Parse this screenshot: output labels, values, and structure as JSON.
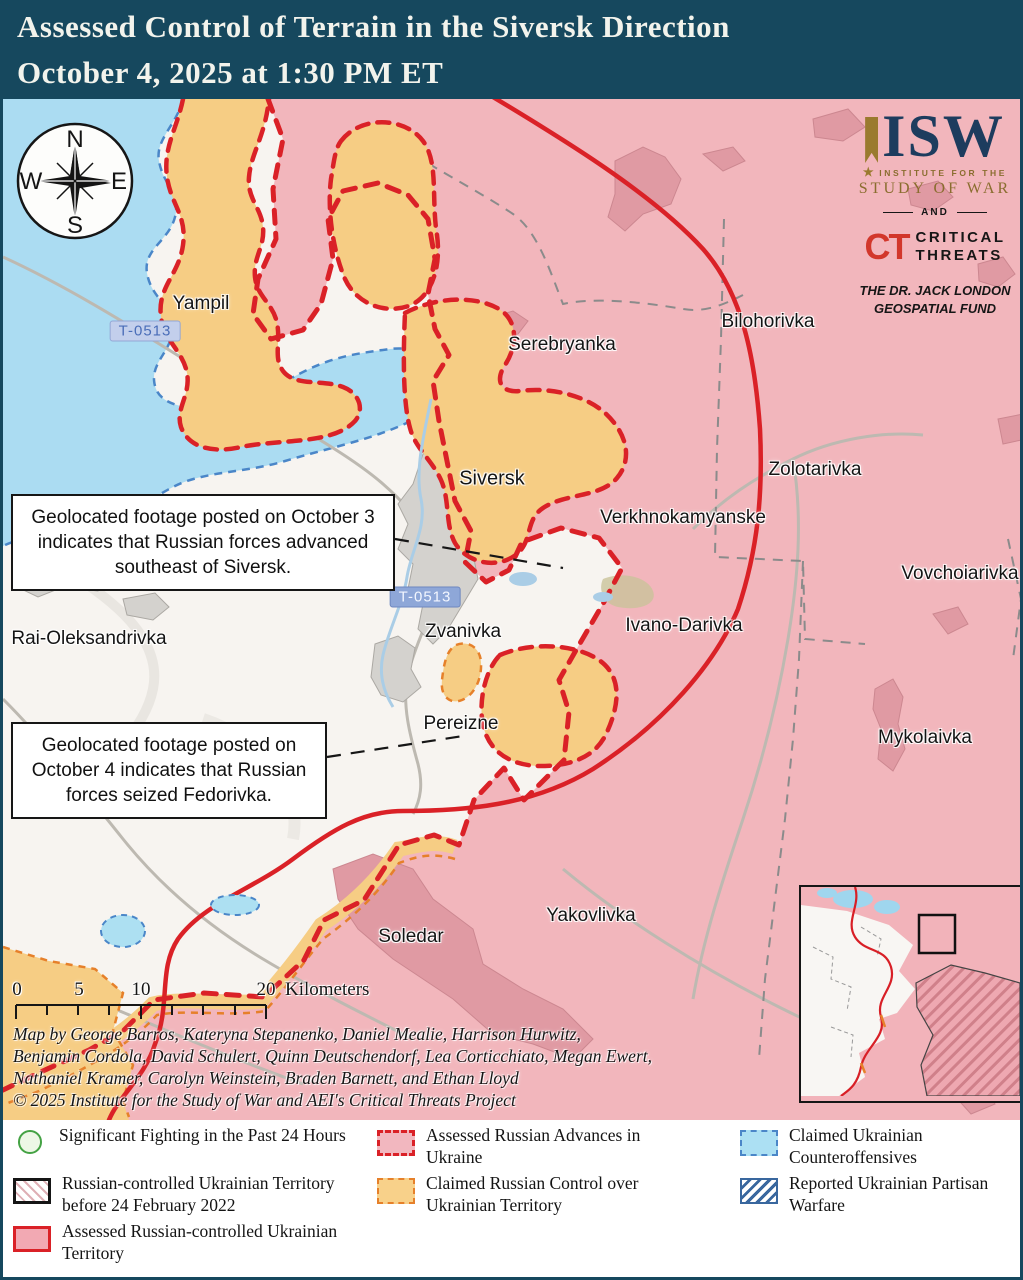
{
  "title": {
    "line1": "Assessed Control of Terrain in the Siversk Direction",
    "line2": "October 4, 2025 at 1:30 PM ET"
  },
  "branding": {
    "isw": "ISW",
    "institute_small": "INSTITUTE FOR THE",
    "study_of_war": "STUDY OF WAR",
    "and": "AND",
    "ct": "CT",
    "critical": "CRITICAL",
    "threats": "THREATS",
    "fund_line1": "THE DR. JACK LONDON",
    "fund_line2": "GEOSPATIAL FUND"
  },
  "compass": {
    "north": "N",
    "east": "E",
    "south": "S",
    "west": "W"
  },
  "map": {
    "labels": [
      {
        "text": "Yampil",
        "x": 198,
        "y": 205
      },
      {
        "text": "Serebryanka",
        "x": 559,
        "y": 246
      },
      {
        "text": "Bilohorivka",
        "x": 765,
        "y": 223
      },
      {
        "text": "Zolotarivka",
        "x": 812,
        "y": 371
      },
      {
        "text": "Verkhnokamyanske",
        "x": 680,
        "y": 419
      },
      {
        "text": "Vovchoiarivka",
        "x": 957,
        "y": 475
      },
      {
        "text": "Siversk",
        "x": 489,
        "y": 380
      },
      {
        "text": "Ivano-Darivka",
        "x": 681,
        "y": 527
      },
      {
        "text": "Rai-Oleksandrivka",
        "x": 86,
        "y": 540
      },
      {
        "text": "Zvanivka",
        "x": 460,
        "y": 533
      },
      {
        "text": "Pereizne",
        "x": 458,
        "y": 625
      },
      {
        "text": "Mykolaivka",
        "x": 922,
        "y": 639
      },
      {
        "text": "Yakovlivka",
        "x": 588,
        "y": 817
      },
      {
        "text": "Soledar",
        "x": 408,
        "y": 838
      }
    ],
    "road_badges": [
      {
        "text": "T-0513",
        "x": 142,
        "y": 232
      },
      {
        "text": "T-0513",
        "x": 422,
        "y": 498
      }
    ],
    "annotations": [
      {
        "text": "Geolocated footage posted on October 3 indicates that Russian forces advanced southeast of Siversk."
      },
      {
        "text": "Geolocated footage posted on October 4 indicates that Russian forces seized Fedorivka."
      }
    ],
    "colors": {
      "title_bar": "#16485e",
      "russian_control_fill": "#f2b6bc",
      "claimed_russian_fill": "#f6cd84",
      "counteroffensive_fill": "#abdcf2",
      "front_line_red": "#da2127",
      "claimed_orange_dash": "#e6802a",
      "ukrainian_blue_dash": "#4a86c8"
    }
  },
  "scale_bar": {
    "tick_labels": [
      "0",
      "5",
      "10",
      "20"
    ],
    "unit": "Kilometers"
  },
  "credits": {
    "line1": "Map by George Barros, Kateryna Stepanenko, Daniel Mealie, Harrison Hurwitz,",
    "line2": "Benjamin Cordola, David Schulert, Quinn Deutschendorf, Lea Corticchiato, Megan Ewert,",
    "line3": "Nathaniel Kramer, Carolyn Weinstein, Braden Barnett, and Ethan Lloyd",
    "line4": "© 2025 Institute for the Study of War and AEI's Critical Threats Project"
  },
  "legend": {
    "items": [
      {
        "label": "Significant Fighting in the Past 24 Hours"
      },
      {
        "label": "Russian-controlled Ukrainian Territory before 24 February 2022"
      },
      {
        "label": "Assessed Russian-controlled Ukrainian Territory"
      },
      {
        "label": "Assessed Russian Advances in Ukraine"
      },
      {
        "label": "Claimed Russian Control over Ukrainian Territory"
      },
      {
        "label": "Claimed Ukrainian Counteroffensives"
      },
      {
        "label": "Reported Ukrainian Partisan Warfare"
      }
    ]
  }
}
